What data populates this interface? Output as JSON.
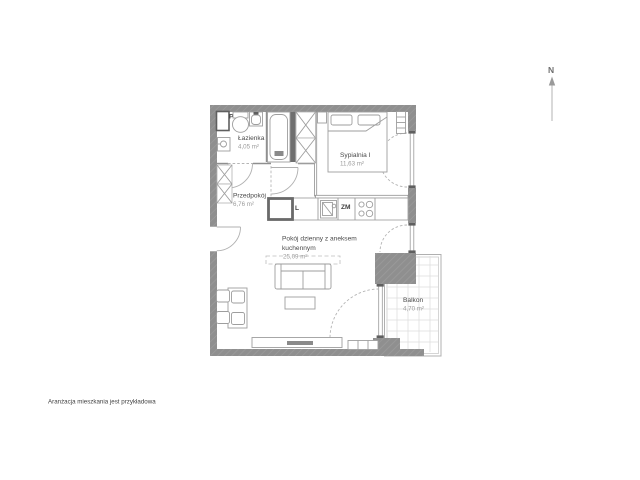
{
  "plan": {
    "rooms": [
      {
        "id": "lazienka",
        "name": "Łazienka",
        "area": "4,05 m²"
      },
      {
        "id": "sypialnia",
        "name": "Sypialnia I",
        "area": "11,63 m²"
      },
      {
        "id": "przedpokoj",
        "name": "Przedpokój",
        "area": "6,76 m²"
      },
      {
        "id": "pokoj",
        "name_line1": "Pokój dzienny  z aneksem",
        "name_line2": "kuchennym",
        "area": "25,09 m²"
      },
      {
        "id": "balkon",
        "name": "Balkon",
        "area": "4,70 m²"
      }
    ],
    "kitchen": {
      "fridge_label": "L",
      "dishwasher_label": "ZM"
    },
    "shaft": {
      "label": "P"
    },
    "compass": {
      "label": "N"
    },
    "caption": {
      "text": "Aranżacja mieszkania jest przykładowa"
    },
    "colors": {
      "wall": "#8f8f8f",
      "wall_dark": "#666666",
      "furniture_line": "#9e9e9e",
      "text_primary": "#4a4a4a",
      "text_secondary": "#9b9b9b",
      "background": "#ffffff"
    }
  }
}
